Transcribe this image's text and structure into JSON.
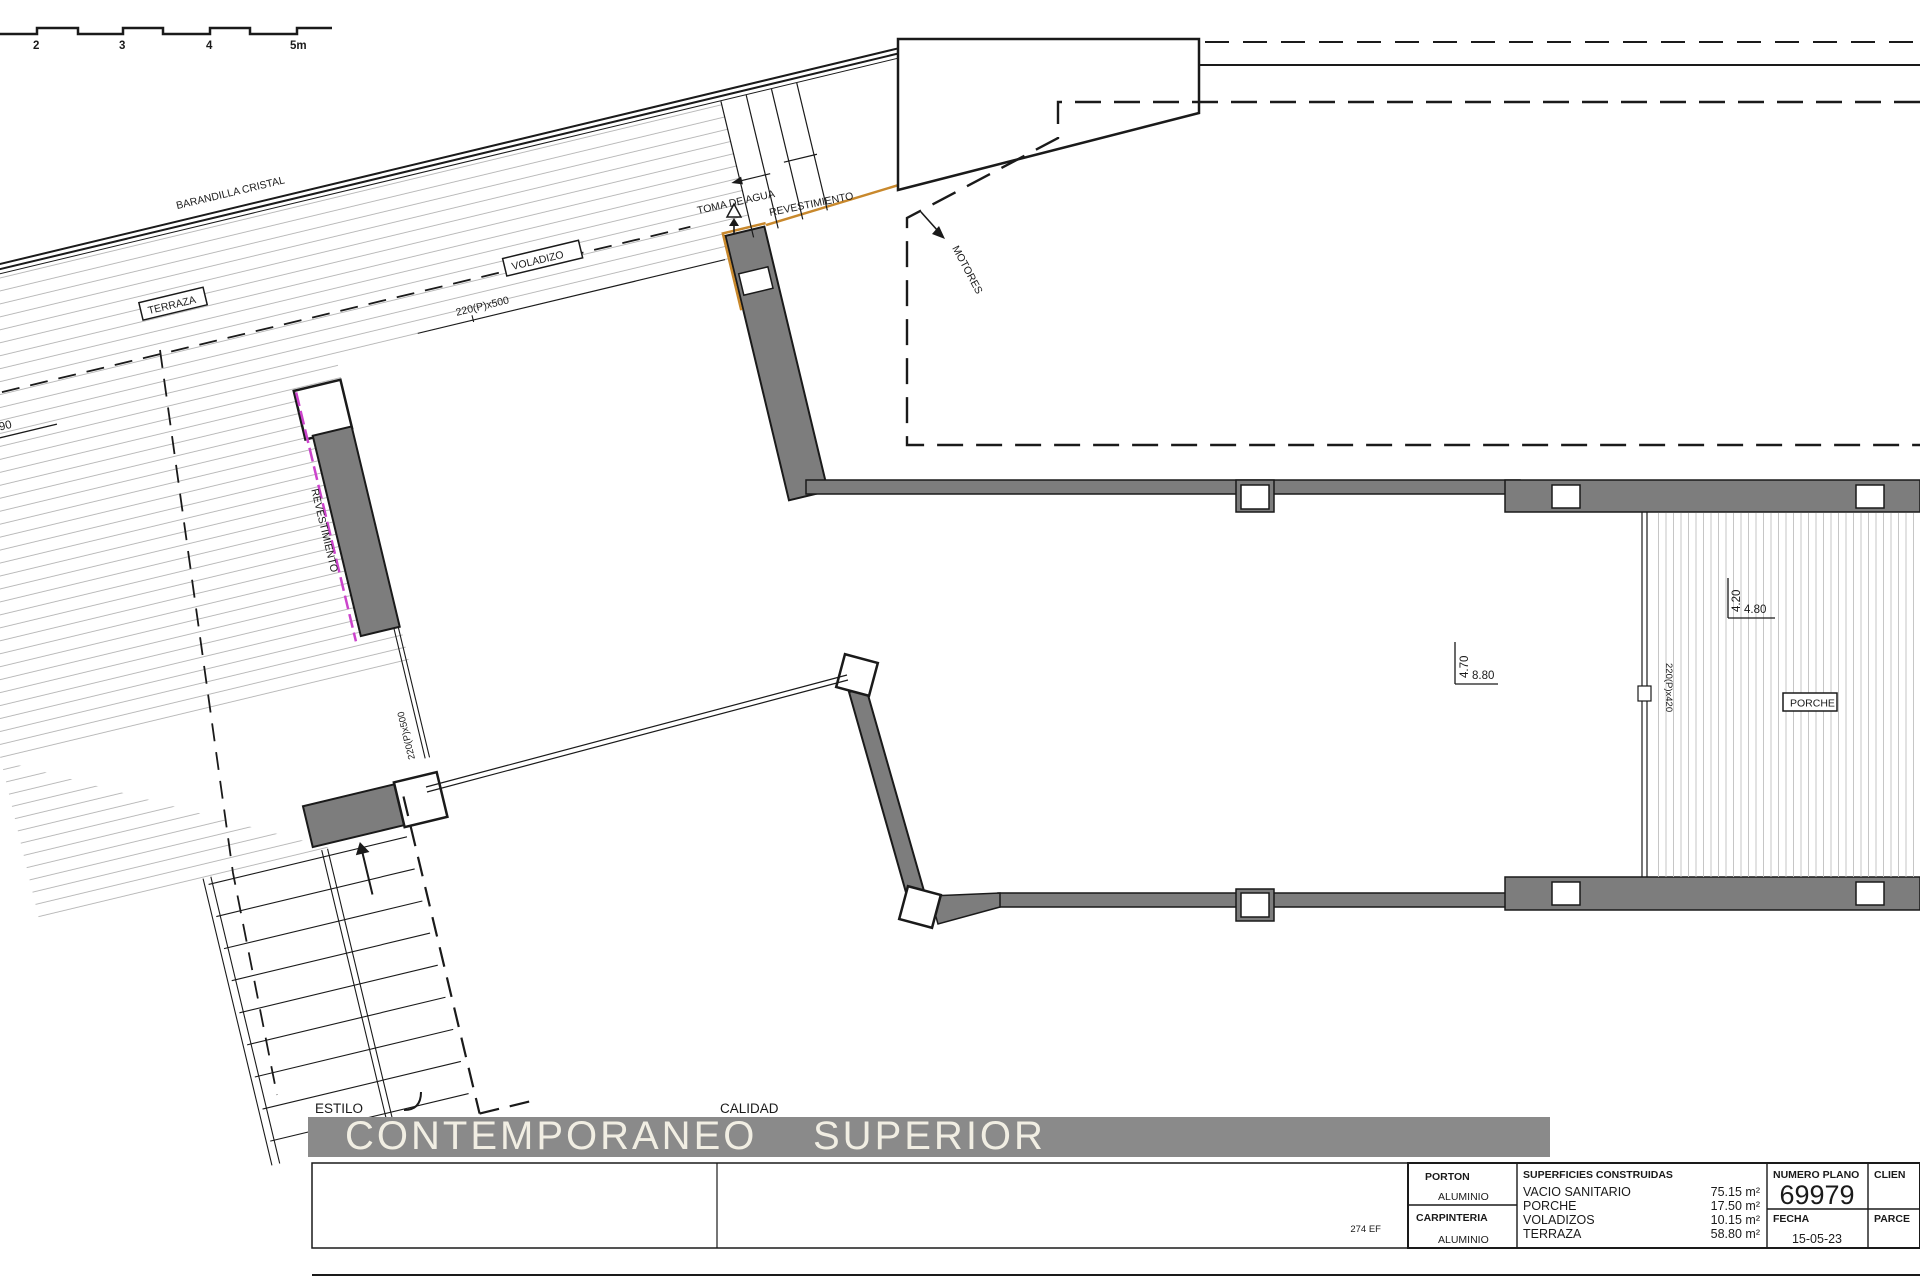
{
  "scale_bar": {
    "labels": [
      "2",
      "3",
      "4",
      "5m"
    ]
  },
  "terrace": {
    "railing_label": "BARANDILLA CRISTAL",
    "area_label": "TERRAZA",
    "overhang_label": "VOLADIZO",
    "dim_width": "10.90",
    "dim_left_partial": "9.25",
    "window_top_label": "220(P)x500",
    "window_left_label": "220(P)x500",
    "cladding_wall_label": "REVESTIMIENTO",
    "cladding_top_label": "REVESTIMIENTO",
    "water_label": "TOMA DE AGUA"
  },
  "machines_label": "MOTORES",
  "living": {
    "dim_a": "4.70",
    "dim_b": "8.80"
  },
  "porch": {
    "label": "PORCHE",
    "window_label": "220(P)x420",
    "dim_a": "4.20",
    "dim_b": "4.80"
  },
  "footer": {
    "estilo_label": "ESTILO",
    "estilo_value": "CONTEMPORANEO",
    "calidad_label": "CALIDAD",
    "calidad_value": "SUPERIOR"
  },
  "title_block": {
    "ref": "274 EF",
    "porton": {
      "label": "PORTON",
      "value": "ALUMINIO"
    },
    "carpinteria": {
      "label": "CARPINTERIA",
      "value": "ALUMINIO"
    },
    "superficies": {
      "header": "SUPERFICIES CONSTRUIDAS",
      "rows": [
        {
          "name": "VACIO SANITARIO",
          "value": "75.15 m²"
        },
        {
          "name": "PORCHE",
          "value": "17.50 m²"
        },
        {
          "name": "VOLADIZOS",
          "value": "10.15 m²"
        },
        {
          "name": "TERRAZA",
          "value": "58.80 m²"
        }
      ]
    },
    "numero_plano": {
      "label": "NUMERO PLANO",
      "value": "69979"
    },
    "fecha": {
      "label": "FECHA",
      "value": "15-05-23"
    },
    "cliente_label": "CLIEN",
    "parcela_label": "PARCE"
  },
  "colors": {
    "wall_gray": "#7d7d7d",
    "bar_gray": "#8a8a8a",
    "accent_orange": "#c8882c",
    "accent_magenta": "#cc44cc",
    "hatch_gray": "#b0b0b0"
  }
}
